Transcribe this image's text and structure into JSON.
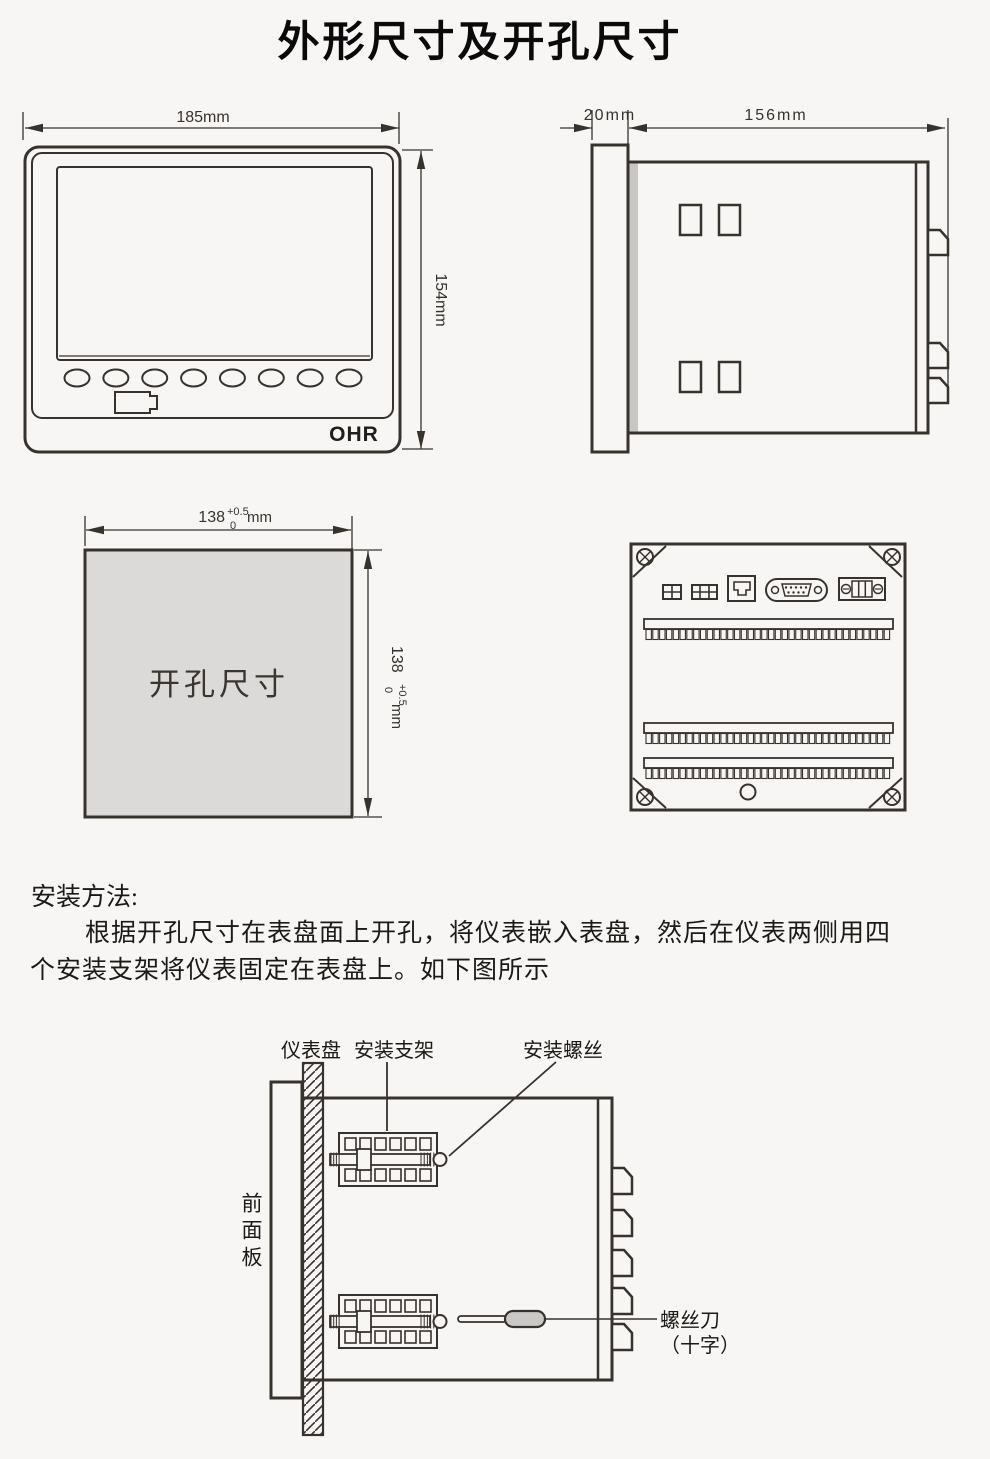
{
  "title": "外形尺寸及开孔尺寸",
  "front_view": {
    "width_label": "185mm",
    "height_label": "154mm",
    "logo": "OHR"
  },
  "side_view": {
    "bezel_label": "20mm",
    "depth_label": "156mm"
  },
  "cutout": {
    "label": "开孔尺寸",
    "dim": "138",
    "tol_plus": "+0.5",
    "tol_zero": "0",
    "unit": "mm"
  },
  "install": {
    "heading": "安装方法:",
    "line1": "根据开孔尺寸在表盘面上开孔，将仪表嵌入表盘，然后在仪表两侧用四",
    "line2": "个安装支架将仪表固定在表盘上。如下图所示"
  },
  "diagram": {
    "panel_label": "仪表盘",
    "bracket_label": "安装支架",
    "screw_label": "安装螺丝",
    "front_panel_label": "前面板",
    "screwdriver_label": "螺丝刀",
    "screwdriver_type": "（十字）"
  },
  "colors": {
    "line": "#38322d",
    "background": "#f7f6f4",
    "cutout_fill": "#dbdad8",
    "handle_fill": "#c9c8c6",
    "shadow": "#c9c7c4"
  },
  "geometry": {
    "buttons": {
      "count": 8,
      "cx0": 77,
      "dx": 38.86,
      "cy": 378,
      "rx": 12.5,
      "ry": 8.5
    },
    "strips": {
      "x": 644,
      "w": 249,
      "ys": [
        619,
        723,
        758
      ],
      "cells": 36
    },
    "side_rects": {
      "w": 21,
      "h": 30,
      "pos": [
        [
          680,
          205
        ],
        [
          719,
          205
        ],
        [
          680,
          362
        ],
        [
          719,
          362
        ]
      ]
    },
    "side_latches": {
      "x": 928,
      "ys": [
        230,
        343,
        378
      ]
    },
    "install_latches": {
      "x": 612,
      "ys": [
        1168,
        1210,
        1250,
        1288,
        1324
      ]
    },
    "screws": [
      [
        645,
        557
      ],
      [
        892,
        557
      ],
      [
        645,
        797
      ],
      [
        892,
        797
      ]
    ],
    "brackets": {
      "ys": [
        1133,
        1295
      ]
    },
    "arrows": [
      {
        "x": 25,
        "y": 128,
        "d": "l"
      },
      {
        "x": 399,
        "y": 128,
        "d": "r"
      },
      {
        "x": 421,
        "y": 151,
        "d": "u"
      },
      {
        "x": 421,
        "y": 449,
        "d": "d"
      },
      {
        "x": 592,
        "y": 128,
        "d": "r"
      },
      {
        "x": 629,
        "y": 128,
        "d": "l"
      },
      {
        "x": 945,
        "y": 128,
        "d": "r"
      },
      {
        "x": 86,
        "y": 530,
        "d": "l"
      },
      {
        "x": 351,
        "y": 530,
        "d": "r"
      },
      {
        "x": 368,
        "y": 551,
        "d": "u"
      },
      {
        "x": 368,
        "y": 816,
        "d": "d"
      }
    ]
  }
}
